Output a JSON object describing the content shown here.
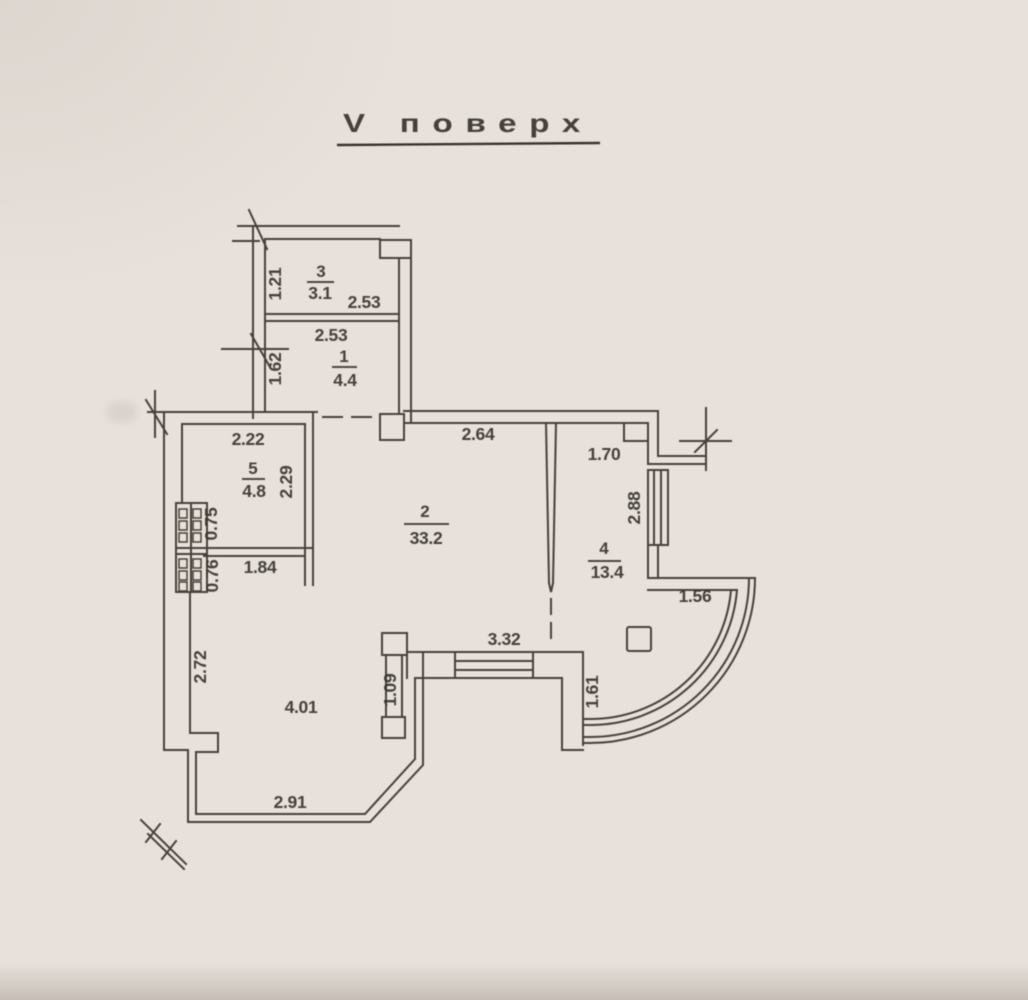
{
  "palette": {
    "paper": "#e8e1db",
    "ink_lines": "#46413b",
    "ink_text": "#38332e"
  },
  "title": {
    "text": "V поверх"
  },
  "rooms": [
    {
      "number": "1",
      "area": "4.4"
    },
    {
      "number": "2",
      "area": "33.2"
    },
    {
      "number": "3",
      "area": "3.1"
    },
    {
      "number": "4",
      "area": "13.4"
    },
    {
      "number": "5",
      "area": "4.8"
    }
  ],
  "dimensions": {
    "d_1_21": "1.21",
    "d_2_53_room3": "2.53",
    "d_2_53_room1": "2.53",
    "d_1_62": "1.62",
    "d_2_22": "2.22",
    "d_2_29": "2.29",
    "d_0_75": "0.75",
    "d_0_76": "0.76",
    "d_1_84": "1.84",
    "d_2_64": "2.64",
    "d_1_70": "1.70",
    "d_2_88": "2.88",
    "d_1_56": "1.56",
    "d_3_32": "3.32",
    "d_1_61": "1.61",
    "d_1_09": "1.09",
    "d_2_72": "2.72",
    "d_4_01": "4.01",
    "d_2_91": "2.91"
  }
}
